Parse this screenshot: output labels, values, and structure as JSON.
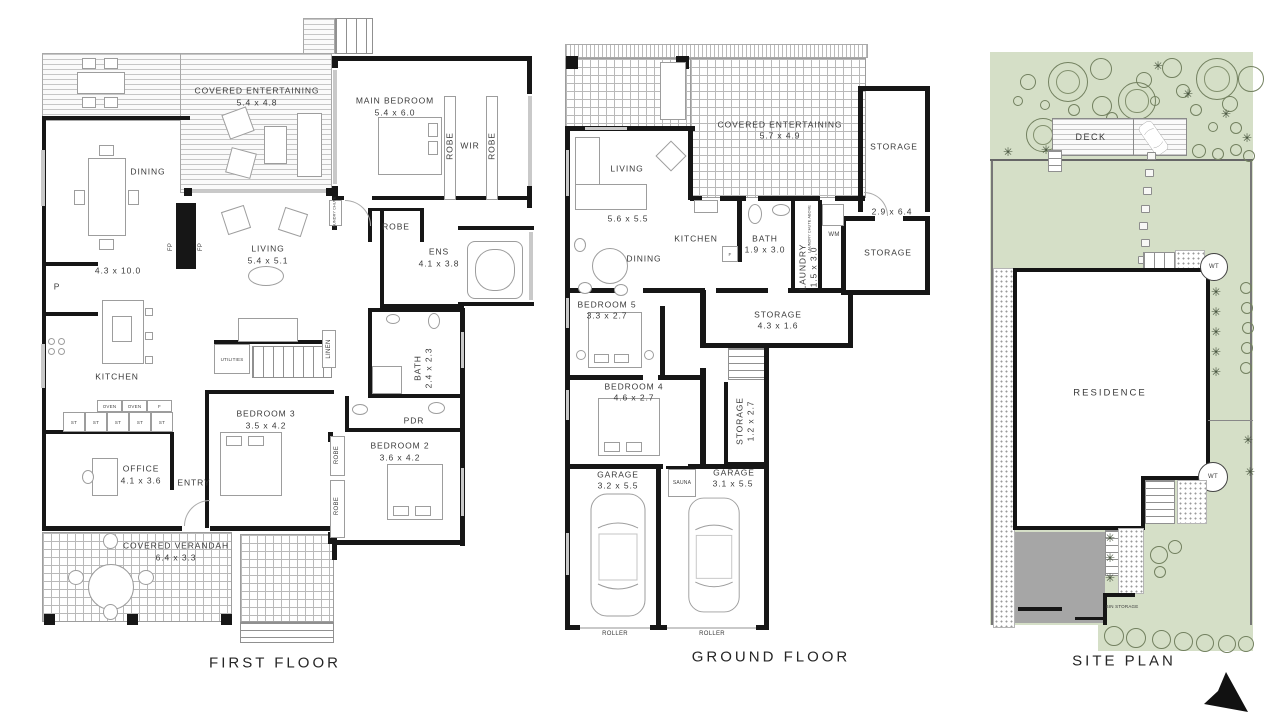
{
  "colors": {
    "wall": "#161616",
    "line": "#9d9d9d",
    "site_green": "#d5dfc7",
    "driveway": "#a6a6a6",
    "text": "#3a3a3a"
  },
  "first_floor": {
    "title": "FIRST FLOOR",
    "rooms": {
      "covered_entertaining": {
        "name": "COVERED ENTERTAINING",
        "dims": "5.4 x 4.8"
      },
      "main_bedroom": {
        "name": "MAIN BEDROOM",
        "dims": "5.4 x 6.0"
      },
      "wir": {
        "name": "WIR"
      },
      "robe_wir_left": {
        "name": "ROBE"
      },
      "robe_wir_right": {
        "name": "ROBE"
      },
      "dining": {
        "name": "DINING",
        "dims": "4.3 x 10.0"
      },
      "living": {
        "name": "LIVING",
        "dims": "5.4 x 5.1"
      },
      "fireplace_left": {
        "name": "FP"
      },
      "fireplace_right": {
        "name": "FP"
      },
      "laundry_chute": {
        "name": "LAUNDRY CHUTE"
      },
      "robe_hall": {
        "name": "ROBE"
      },
      "ens": {
        "name": "ENS",
        "dims": "4.1 x 3.8"
      },
      "pantry": {
        "name": "P"
      },
      "kitchen": {
        "name": "KITCHEN"
      },
      "oven1": {
        "name": "OVEN"
      },
      "oven2": {
        "name": "OVEN"
      },
      "fridge": {
        "name": "F"
      },
      "st1": {
        "name": "ST"
      },
      "st2": {
        "name": "ST"
      },
      "st3": {
        "name": "ST"
      },
      "st4": {
        "name": "ST"
      },
      "st5": {
        "name": "ST"
      },
      "utilities": {
        "name": "UTILITIES"
      },
      "linen": {
        "name": "LINEN"
      },
      "bedroom3": {
        "name": "BEDROOM 3",
        "dims": "3.5 x 4.2"
      },
      "bath": {
        "name": "BATH",
        "dims": "2.4 x 2.3"
      },
      "pdr": {
        "name": "PDR"
      },
      "bedroom2": {
        "name": "BEDROOM 2",
        "dims": "3.6 x 4.2"
      },
      "robe_b2_top": {
        "name": "ROBE"
      },
      "robe_b2_bottom": {
        "name": "ROBE"
      },
      "office": {
        "name": "OFFICE",
        "dims": "4.1 x 3.6"
      },
      "entry": {
        "name": "ENTRY"
      },
      "covered_verandah": {
        "name": "COVERED VERANDAH",
        "dims": "6.4 x 3.3"
      }
    }
  },
  "ground_floor": {
    "title": "GROUND FLOOR",
    "rooms": {
      "covered_entertaining": {
        "name": "COVERED ENTERTAINING",
        "dims": "5.7 x 4.9"
      },
      "living": {
        "name": "LIVING",
        "dims": "5.6 x 5.5"
      },
      "dining": {
        "name": "DINING"
      },
      "kitchen": {
        "name": "KITCHEN"
      },
      "fridge": {
        "name": "F"
      },
      "bath": {
        "name": "BATH",
        "dims": "1.9 x 3.0"
      },
      "laundry": {
        "name": "LAUNDRY",
        "dims": "1.5 x 3.0"
      },
      "laundry_chute_above": {
        "name": "LAUNDRY CHUTE ABOVE"
      },
      "wm": {
        "name": "WM"
      },
      "storage_top": {
        "name": "STORAGE",
        "dims": "2.9 x 6.4"
      },
      "storage_mid": {
        "name": "STORAGE"
      },
      "bedroom5": {
        "name": "BEDROOM 5",
        "dims": "3.3 x 2.7"
      },
      "storage_hall": {
        "name": "STORAGE",
        "dims": "4.3 x 1.6"
      },
      "bedroom4": {
        "name": "BEDROOM 4",
        "dims": "4.6 x 2.7"
      },
      "storage_corridor": {
        "name": "STORAGE",
        "dims": "1.2 x 2.7"
      },
      "garage1": {
        "name": "GARAGE",
        "dims": "3.2 x 5.5"
      },
      "sauna": {
        "name": "SAUNA"
      },
      "garage2": {
        "name": "GARAGE",
        "dims": "3.1 x 5.5"
      },
      "roller1": {
        "name": "ROLLER"
      },
      "roller2": {
        "name": "ROLLER"
      }
    }
  },
  "site_plan": {
    "title": "SITE PLAN",
    "deck": "DECK",
    "residence": "RESIDENCE",
    "water_tank1": "WT",
    "water_tank2": "WT",
    "bin_storage": "BIN STORAGE"
  }
}
